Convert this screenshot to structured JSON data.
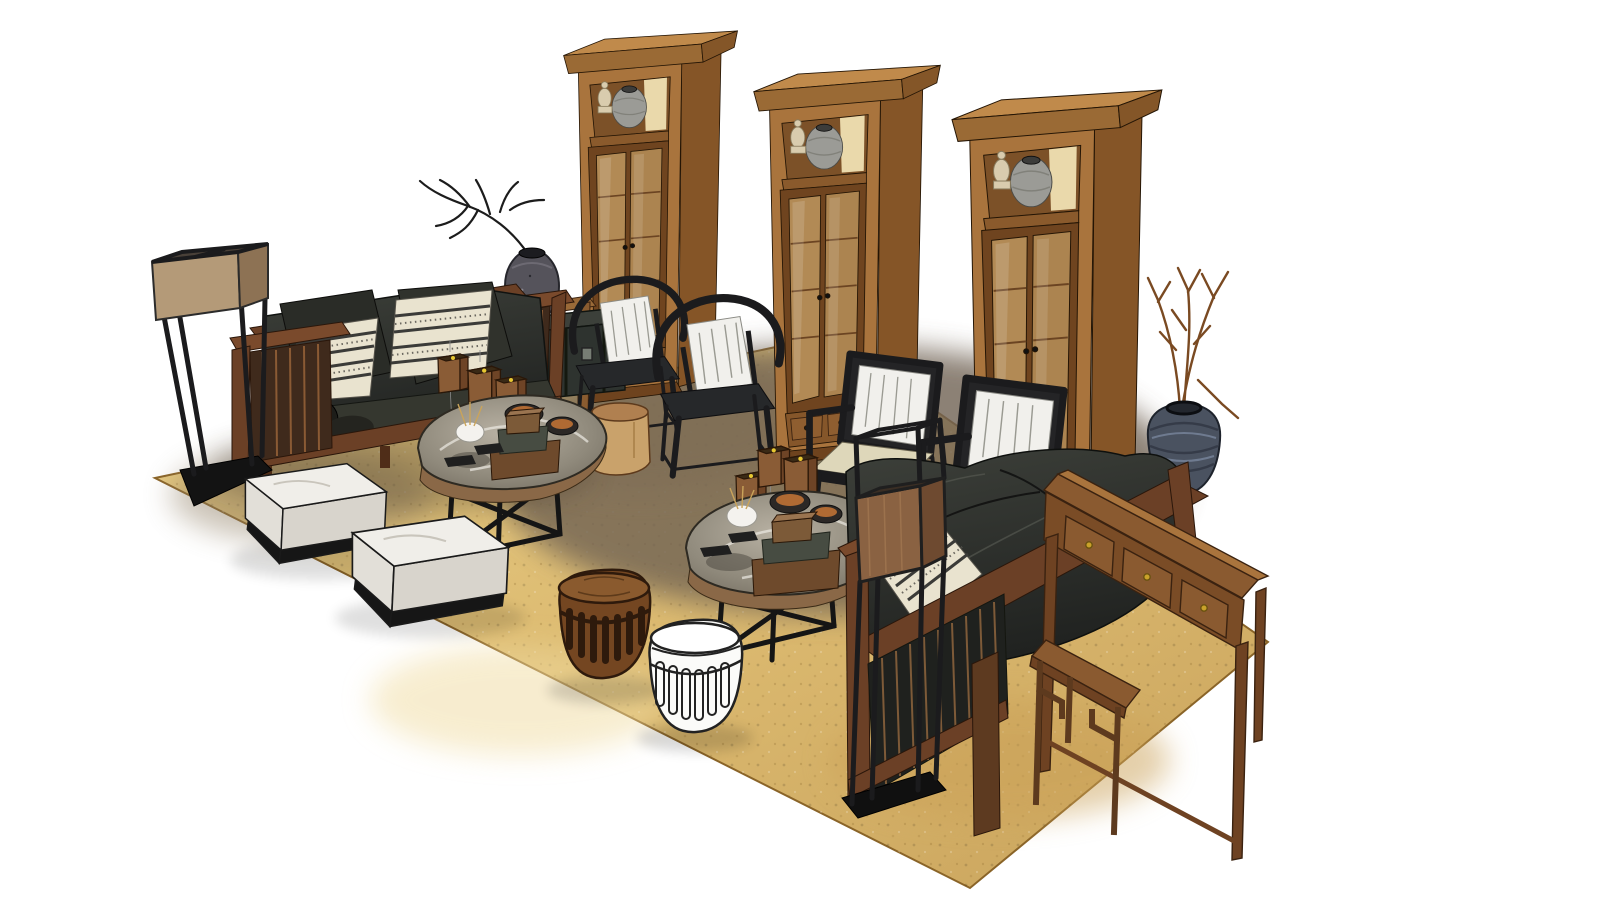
{
  "scene": {
    "description": "3D rendered Chinese-style living room furniture set on a gold mottled rug against a white background",
    "background": "#ffffff",
    "palette": {
      "background": "#ffffff",
      "wood_front": "#a9743d",
      "wood_side": "#855527",
      "wood_crown": "#c08a4b",
      "wood_light": "#c9a06a",
      "wood_dark": "#6e431e",
      "sofa_frame": "#6b4026",
      "sofa_frame_dark": "#4f2d18",
      "cushion_dark": "#2c2e2a",
      "cushion_mid": "#3a3d37",
      "pillow_cream": "#e9e3cf",
      "pillow_white": "#f1f0ec",
      "stripe_dark": "#3b3b38",
      "seat_cream": "#ded7ba",
      "metal_black": "#1b1b1d",
      "rug_gold": "#dcba70",
      "rug_gold_light": "#ecd28e",
      "rug_shadow": "#6f6252",
      "marble_base": "#98907f",
      "marble_vein": "#eceae2",
      "table_wood_edge": "#8a6847",
      "ceramic_gray": "#9b9b96",
      "ceramic_cream": "#d9ccae",
      "vase_dark": "#55535b",
      "vase_blue": "#4a5260",
      "brass": "#c9a22a",
      "bowl_copper": "#b06a33",
      "box_wood": "#8a5c36",
      "box_green": "#474c42",
      "trunk": "#2e332f",
      "lamp_shade_tan": "#b49a78",
      "lamp_shade_wood": "#8a6242",
      "white_stool": "#fbfbf9",
      "barrel_wood": "#744621",
      "stump": "#c9a26b",
      "branch": "#7a4a22",
      "branch_dark": "#1c1c1c"
    },
    "objects": [
      {
        "name": "area-rug",
        "label": "Gold mottled area rug with darker worn center"
      },
      {
        "name": "display-cabinet-left",
        "label": "Tall wooden display cabinet, glass doors, jar and sculpture in top niche"
      },
      {
        "name": "display-cabinet-middle",
        "label": "Tall wooden display cabinet, glass doors, two lower drawers"
      },
      {
        "name": "display-cabinet-right",
        "label": "Tall wooden display cabinet, glass doors, jar and sculpture in top niche"
      },
      {
        "name": "console-behind-left-sofa",
        "label": "Wooden console table behind left sofa"
      },
      {
        "name": "speckled-vase-with-branch",
        "label": "Dark speckled ceramic vase with dry branch"
      },
      {
        "name": "storage-trunk",
        "label": "Dark storage trunk beside left sofa"
      },
      {
        "name": "left-sofa",
        "label": "Wooden frame sofa with dark gray cushions, striped pillows and bolster"
      },
      {
        "name": "hanging-lantern-boxes-left",
        "label": "Three small wooden box lanterns suspended over left coffee table"
      },
      {
        "name": "floor-lamp-left",
        "label": "Tall black frame floor lamp with square tan fabric shade"
      },
      {
        "name": "horseshoe-chair-1",
        "label": "Black horseshoe-back Chinese armchair with white pillow"
      },
      {
        "name": "horseshoe-chair-2",
        "label": "Black horseshoe-back Chinese armchair with white pillow"
      },
      {
        "name": "tree-stump-side-table",
        "label": "Natural tree stump side table"
      },
      {
        "name": "coffee-table-left",
        "label": "Live-edge slab coffee table, marbled top, black metal legs, trays boxes and bowls"
      },
      {
        "name": "ottoman-1",
        "label": "White upholstered ottoman with black plinth"
      },
      {
        "name": "ottoman-2",
        "label": "White upholstered ottoman with black plinth"
      },
      {
        "name": "armchair-1",
        "label": "Black frame lounge chair with cream seat and white pillow"
      },
      {
        "name": "armchair-2",
        "label": "Black frame lounge chair with cream seat and white pillow"
      },
      {
        "name": "hanging-lantern-boxes-center",
        "label": "Three small wooden box lanterns suspended over right coffee table"
      },
      {
        "name": "coffee-table-right",
        "label": "Live-edge slab coffee table, marbled top, stacked boxes, copper bowls, white vase"
      },
      {
        "name": "ribbed-jar-with-branches",
        "label": "Blue-gray ribbed ceramic jar with dry branches"
      },
      {
        "name": "right-sofa",
        "label": "Wooden frame sofa seen from behind, dark gray cushions, slatted back"
      },
      {
        "name": "console-table-right",
        "label": "Long wooden console table with three drawers and brass knobs"
      },
      {
        "name": "fretwork-bench",
        "label": "Small Ming-style side bench with fretwork legs"
      },
      {
        "name": "floor-lamp-front",
        "label": "Tall black frame floor lamp with square wood-panel shade"
      },
      {
        "name": "barrel-stool-wood",
        "label": "Carved wooden barrel drum stool with vertical slots"
      },
      {
        "name": "barrel-stool-white",
        "label": "White ceramic drum stool with vertical slots"
      }
    ]
  }
}
